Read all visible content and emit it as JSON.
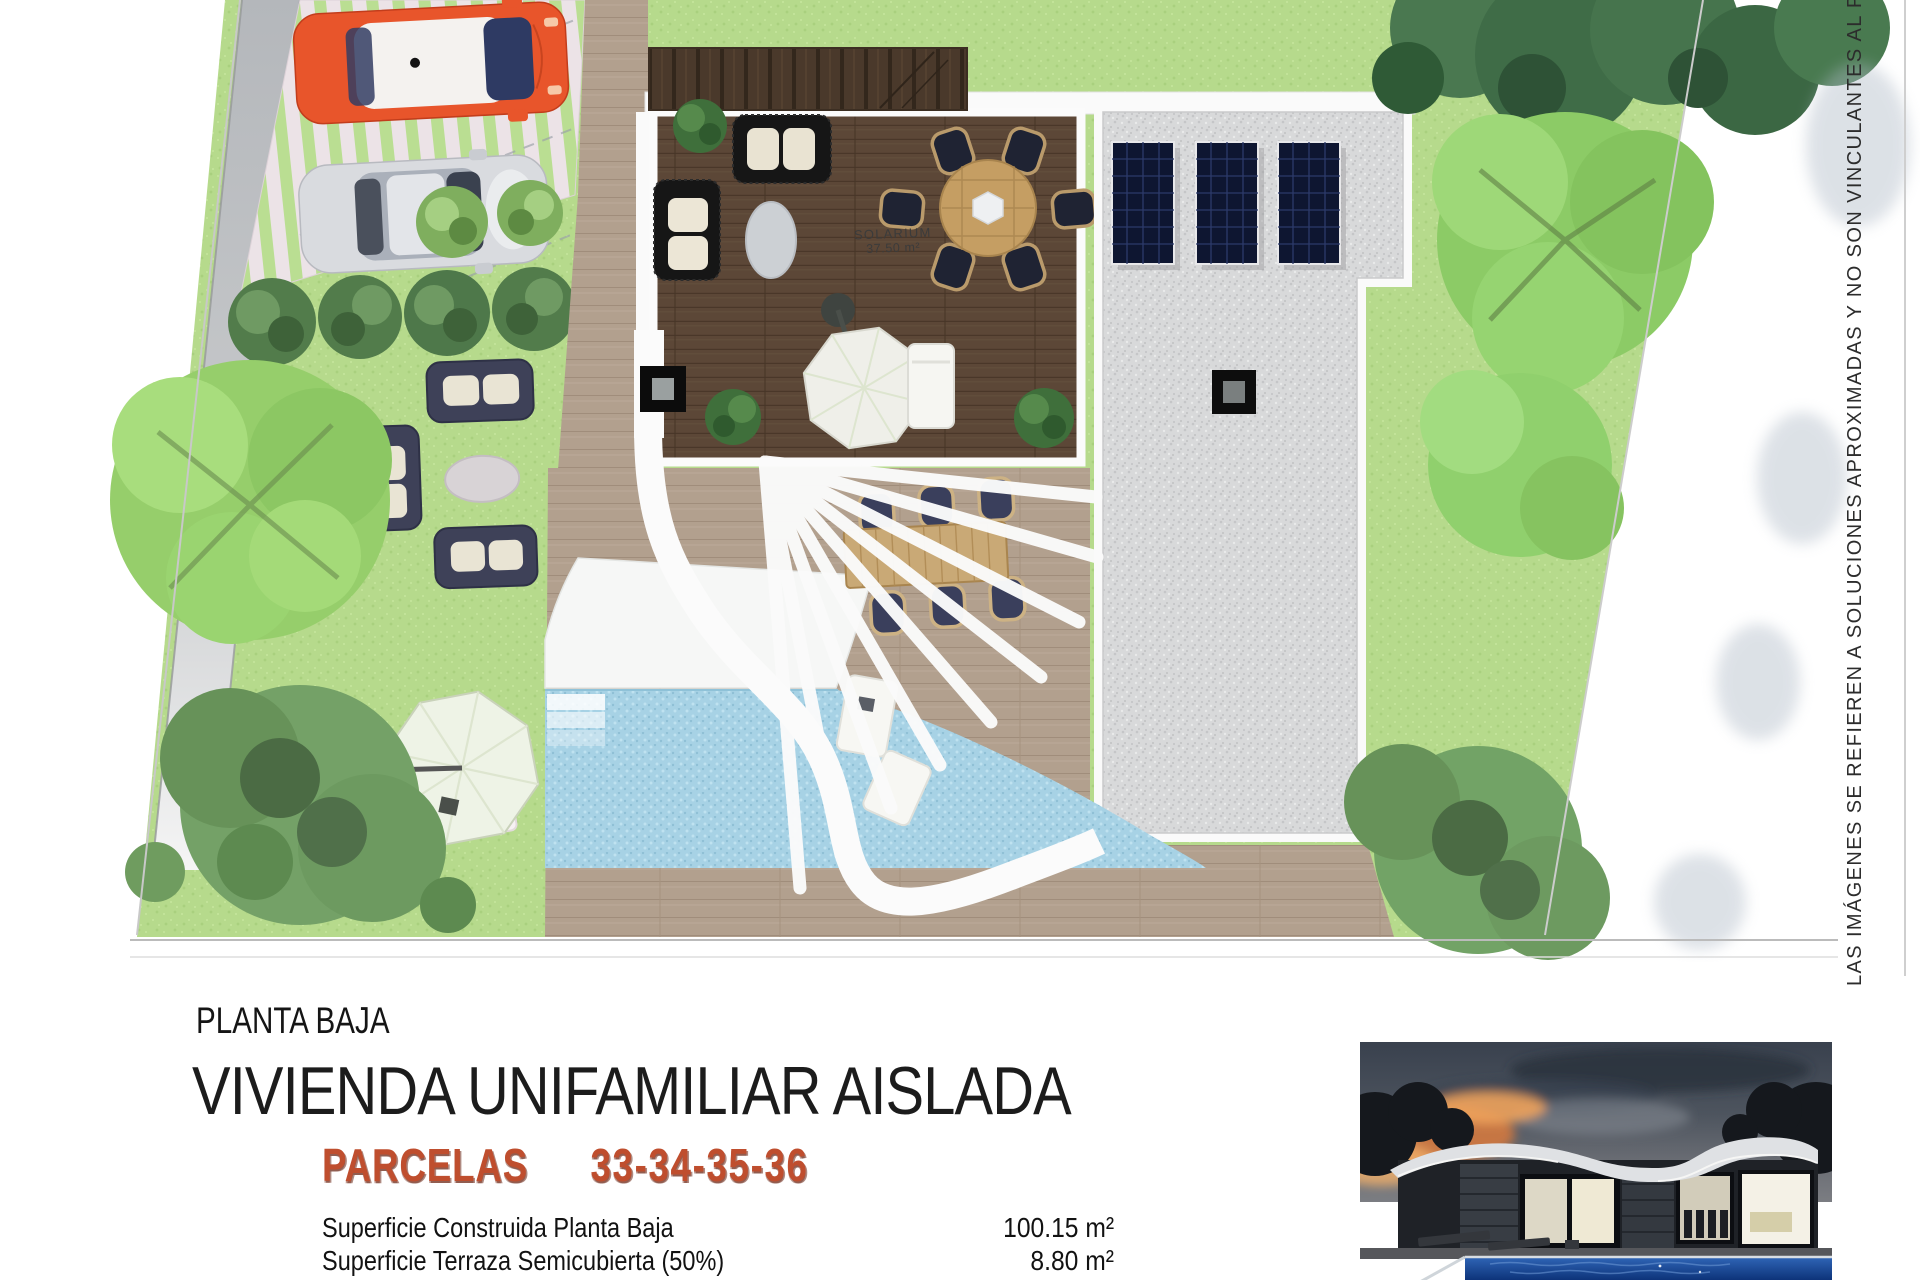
{
  "plan": {
    "solarium_label": "SOLARIUM",
    "solarium_area": "37.50 m²"
  },
  "caption": {
    "floor_label": "PLANTA BAJA",
    "title": "VIVIENDA UNIFAMILIAR AISLADA",
    "parcels_label": "PARCELAS",
    "parcels_numbers": "33-34-35-36",
    "areas": [
      {
        "label": "Superficie Construida Planta Baja",
        "value": "100.15 m²"
      },
      {
        "label": "Superficie Terraza Semicubierta (50%)",
        "value": "8.80 m²"
      }
    ]
  },
  "disclaimer": "LAS IMÁGENES SE REFIEREN A SOLUCIONES APROXIMADAS Y NO SON VINCULANTES AL PROYECTO",
  "colors": {
    "grass": "#b6da8c",
    "deck_wood": "#5c4737",
    "terrace_wood": "#b2a08e",
    "pool_water": "#a7d2e5",
    "gravel_roof": "#d8d9da",
    "accent_parcels": "#bf4e2e",
    "car_orange": "#e8552b",
    "car_silver": "#d9dbdf",
    "solar_panel": "#0e1631"
  }
}
